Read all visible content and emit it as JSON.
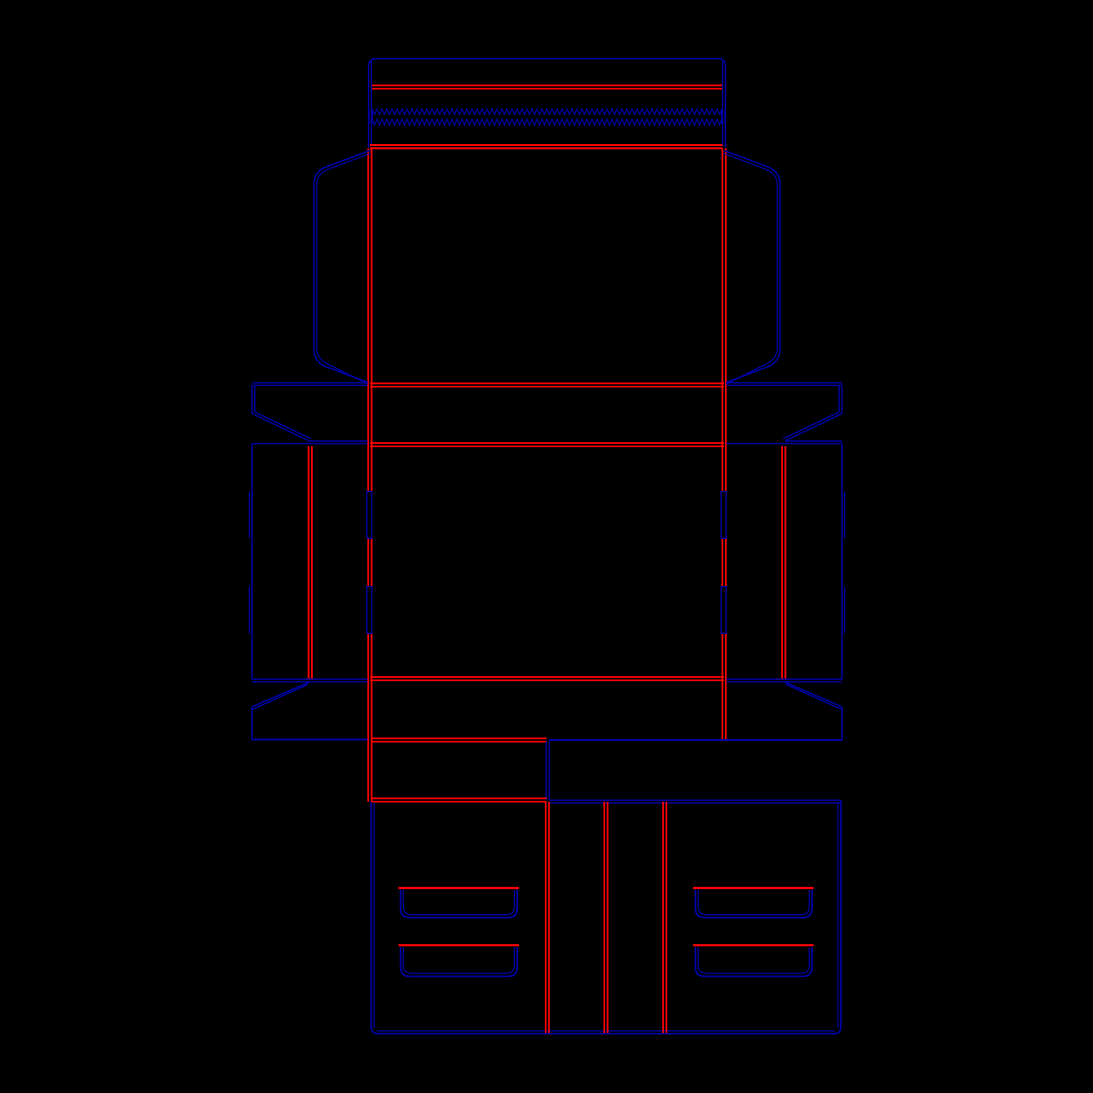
{
  "canvas": {
    "width": 1093,
    "height": 1093,
    "background": "#000000"
  },
  "palette": {
    "cut": "#0000A6",
    "crease": "#FF0000"
  },
  "dieline": {
    "paths": [
      {
        "name": "tuck-flap-outline",
        "color": "cut",
        "width": 1.5,
        "d": "M368.6,147.5 L368.6,66.5 Q368.6,58.6 376.6,58.6 L717.4,58.6 Q725.4,58.6 725.4,66.5 L725.4,147.5"
      },
      {
        "name": "tuck-flap-inner-edge-left",
        "color": "cut",
        "width": 1.2,
        "d": "M371.4,61 V146"
      },
      {
        "name": "tuck-flap-inner-edge-right",
        "color": "cut",
        "width": 1.2,
        "d": "M722.6,61 V146"
      },
      {
        "name": "tuck-flap-crease",
        "color": "crease",
        "width": 1.7,
        "d": "M372,85.4 H722 M372,88.7 H722"
      },
      {
        "name": "tear-strip-end-marks",
        "color": "cut",
        "width": 1.3,
        "d": "M369.1,110.5 V123.5 M372.3,110.5 V123.5 M721.7,110.5 V123.5 M724.9,110.5 V123.5"
      },
      {
        "name": "lid-main-fold",
        "color": "crease",
        "width": 2.0,
        "d": "M370,145 H722.5 M370,148.3 H722.5"
      },
      {
        "name": "lid-fold-left",
        "color": "crease",
        "width": 1.7,
        "d": "M368.2,148.3 V491.5 M368.2,538.3 V586.6 M368.2,633.4 V801.7 M371.6,148.3 V491.5 M371.6,538.3 V586.6 M371.6,633.4 V801.7"
      },
      {
        "name": "lid-fold-right",
        "color": "crease",
        "width": 1.7,
        "d": "M722.4,148.3 V491.5 M722.4,538.3 V586.6 M722.4,633.4 V739.8 M725.8,148.3 V491.5 M725.8,538.3 V586.6 M725.8,633.4 V739.8"
      },
      {
        "name": "dust-flap-left-outer",
        "color": "cut",
        "width": 1.5,
        "d": "M370,150.5 L327,166.5 Q314,171.5 314,183.5 L314,349.5 Q314,359.5 323,365.5 L368,382.5"
      },
      {
        "name": "dust-flap-left-inner",
        "color": "cut",
        "width": 1.2,
        "d": "M370.5,153.3 L328.5,169.2 Q316.8,173.9 316.8,184.5 L316.8,348.2 Q316.8,356.9 324.6,362.3 L367.6,384"
      },
      {
        "name": "dust-flap-right-outer",
        "color": "cut",
        "width": 1.5,
        "d": "M724,150.5 L767,166.5 Q780,171.5 780,183.5 L780,349.5 Q780,359.5 771,365.5 L726,382.5"
      },
      {
        "name": "dust-flap-right-inner",
        "color": "cut",
        "width": 1.2,
        "d": "M723.5,153.3 L765.5,169.2 Q777.2,173.9 777.2,184.5 L777.2,348.2 Q777.2,356.9 769.4,362.3 L726.4,384"
      },
      {
        "name": "lid-bottom-fold",
        "color": "crease",
        "width": 1.7,
        "d": "M370,383.4 H724 M370,386.7 H724"
      },
      {
        "name": "top-band-upper-cut-left",
        "color": "cut",
        "width": 1.4,
        "d": "M252,382.8 H367.6 M252,385.4 H367.6"
      },
      {
        "name": "top-band-upper-cut-right",
        "color": "cut",
        "width": 1.4,
        "d": "M726.4,382.8 H842 M726.4,385.4 H842"
      },
      {
        "name": "top-band-side-left",
        "color": "cut",
        "width": 1.4,
        "d": "M252,385.4 V413.5 M254.8,385.4 V412"
      },
      {
        "name": "top-band-side-right",
        "color": "cut",
        "width": 1.4,
        "d": "M842,385.4 V413.5 M839.2,385.4 V412"
      },
      {
        "name": "top-band-gusset-diagonal-left",
        "color": "cut",
        "width": 1.4,
        "d": "M252,413.5 L309,441 M254.8,412 L311,438.8"
      },
      {
        "name": "top-band-gusset-diagonal-right",
        "color": "cut",
        "width": 1.4,
        "d": "M842,413.5 L785,441 M839.2,412 L783,438.8"
      },
      {
        "name": "top-band-lower-cut-left",
        "color": "cut",
        "width": 1.4,
        "d": "M309,441 H367.6"
      },
      {
        "name": "top-band-lower-cut-right",
        "color": "cut",
        "width": 1.4,
        "d": "M785,441 H842"
      },
      {
        "name": "side-row-top-cut-left",
        "color": "cut",
        "width": 1.4,
        "d": "M252,443.6 H367.6"
      },
      {
        "name": "side-row-top-cut-right",
        "color": "cut",
        "width": 1.4,
        "d": "M726.4,443.6 H842"
      },
      {
        "name": "base-top-fold",
        "color": "crease",
        "width": 1.7,
        "d": "M370,443 H724 M370,446.3 H724"
      },
      {
        "name": "side-row-outer-edge-left",
        "color": "cut",
        "width": 1.5,
        "d": "M252,443.6 V679.2"
      },
      {
        "name": "side-row-outer-edge-right",
        "color": "cut",
        "width": 1.5,
        "d": "M842,443.6 V679.2"
      },
      {
        "name": "side-row-lock-tab-left",
        "color": "cut",
        "width": 1.2,
        "d": "M249.4,491.5 V538.3 M249.4,586.6 V633.4"
      },
      {
        "name": "side-row-lock-tab-right",
        "color": "cut",
        "width": 1.2,
        "d": "M844.6,491.5 V538.3 M844.6,586.6 V633.4"
      },
      {
        "name": "side-wall-crease-left",
        "color": "crease",
        "width": 1.8,
        "d": "M308.6,446.3 V680 M311.9,446.3 V680"
      },
      {
        "name": "side-wall-crease-right",
        "color": "crease",
        "width": 1.8,
        "d": "M782.1,446.3 V680 M785.4,446.3 V680"
      },
      {
        "name": "base-fold-slot-left-1",
        "color": "cut",
        "width": 1.3,
        "d": "M366.8,491.5 h5.0 v46.8 h-5.0 Z"
      },
      {
        "name": "base-fold-slot-left-2",
        "color": "cut",
        "width": 1.3,
        "d": "M366.8,586.6 h5.0 v46.8 h-5.0 Z"
      },
      {
        "name": "base-fold-slot-right-1",
        "color": "cut",
        "width": 1.3,
        "d": "M721.1,491.5 h5.0 v46.8 h-5.0 Z"
      },
      {
        "name": "base-fold-slot-right-2",
        "color": "cut",
        "width": 1.3,
        "d": "M721.1,586.6 h5.0 v46.8 h-5.0 Z"
      },
      {
        "name": "base-bottom-fold",
        "color": "crease",
        "width": 1.7,
        "d": "M370,677 H724 M370,680.3 H724"
      },
      {
        "name": "bottom-band-upper-cut-left",
        "color": "cut",
        "width": 1.4,
        "d": "M252,679.2 H367.6 M252,681.8 H367.6"
      },
      {
        "name": "bottom-band-upper-cut-right",
        "color": "cut",
        "width": 1.4,
        "d": "M726.4,679.2 H842 M726.4,681.8 H842"
      },
      {
        "name": "bottom-band-gusset-diagonal-left",
        "color": "cut",
        "width": 1.4,
        "d": "M310,681.8 L252,706.8 M308,684.4 L252.6,709.4"
      },
      {
        "name": "bottom-band-gusset-diagonal-right",
        "color": "cut",
        "width": 1.4,
        "d": "M784,681.8 L842,706.8 M786,684.4 L841.4,709.4"
      },
      {
        "name": "bottom-band-side-left",
        "color": "cut",
        "width": 1.5,
        "d": "M252,706.8 V739.6"
      },
      {
        "name": "bottom-band-side-right",
        "color": "cut",
        "width": 1.5,
        "d": "M842,706.8 V739.6"
      },
      {
        "name": "bottom-band-lower-cut-left",
        "color": "cut",
        "width": 1.9,
        "d": "M252,739.6 H367.6"
      },
      {
        "name": "bottom-band-lower-cut-right",
        "color": "cut",
        "width": 1.9,
        "d": "M548.5,740 H842"
      },
      {
        "name": "neck-top-fold",
        "color": "crease",
        "width": 1.7,
        "d": "M371,738.4 H546.5 M371,741.7 H546.5"
      },
      {
        "name": "neck-side-cut",
        "color": "cut",
        "width": 1.4,
        "d": "M546.2,741.7 V799.8 M549.2,741.7 V799.8"
      },
      {
        "name": "neck-bottom-fold",
        "color": "crease",
        "width": 1.7,
        "d": "M371,798.4 H546.5 M371,801.7 H546.5"
      },
      {
        "name": "lock-panel-top-cut",
        "color": "cut",
        "width": 1.4,
        "d": "M549.2,800.2 H840.8 M549.2,802.9 H840.8"
      },
      {
        "name": "lock-panel-outline",
        "color": "cut",
        "width": 1.7,
        "d": "M371.3,801.7 L371.3,1026.6 Q371.3,1033.7 378.4,1033.7 L833.7,1033.7 Q840.8,1033.7 840.8,1026.6 L840.8,800.2"
      },
      {
        "name": "lock-panel-inner-edge",
        "color": "cut",
        "width": 1.2,
        "d": "M374.2,803 V1028 M837.9,803 V1028 M377,1030.9 H835"
      },
      {
        "name": "lock-panel-crease-1",
        "color": "crease",
        "width": 1.7,
        "d": "M545.7,801.7 V1033 M549,801.7 V1033"
      },
      {
        "name": "lock-panel-crease-2",
        "color": "crease",
        "width": 1.7,
        "d": "M604.3,801.7 V1033 M607.6,801.7 V1033"
      },
      {
        "name": "lock-panel-crease-3",
        "color": "crease",
        "width": 1.7,
        "d": "M663.1,801.7 V1033 M666.4,801.7 V1033"
      },
      {
        "name": "handle-slot-fold-left-1",
        "color": "crease",
        "width": 2.2,
        "d": "M398.5,888 H519"
      },
      {
        "name": "handle-slot-fold-left-2",
        "color": "crease",
        "width": 2.2,
        "d": "M398.5,945.2 H519"
      },
      {
        "name": "handle-slot-fold-right-1",
        "color": "crease",
        "width": 2.2,
        "d": "M693,888 H813.6"
      },
      {
        "name": "handle-slot-fold-right-2",
        "color": "crease",
        "width": 2.2,
        "d": "M693,945.2 H813.6"
      },
      {
        "name": "handle-slot-cut-left-1",
        "color": "cut",
        "width": 1.7,
        "d": "M400.6,889.8 L400.6,908.4 Q400.6,917.6 409.8,917.6 L508,917.6 Q517.2,917.6 517.2,908.4 L517.2,889.8"
      },
      {
        "name": "handle-slot-cut-left-1-inner",
        "color": "cut",
        "width": 1.2,
        "d": "M403.4,890 L403.4,906.6 Q403.4,914.6 411.4,914.6 L506.4,914.6 Q514.4,914.6 514.4,906.6 L514.4,890"
      },
      {
        "name": "handle-slot-cut-left-2",
        "color": "cut",
        "width": 1.7,
        "d": "M400.6,947 L400.6,967 Q400.6,976.4 410,976.4 L507.8,976.4 Q517.2,976.4 517.2,967 L517.2,947"
      },
      {
        "name": "handle-slot-cut-left-2-inner",
        "color": "cut",
        "width": 1.2,
        "d": "M403.4,947.2 L403.4,965.4 Q403.4,973.2 411.4,973.2 L506.4,973.2 Q514.4,973.2 514.4,965.4 L514.4,947.2"
      },
      {
        "name": "handle-slot-cut-right-1",
        "color": "cut",
        "width": 1.7,
        "d": "M695.4,889.8 L695.4,908.4 Q695.4,917.6 704.6,917.6 L802.8,917.6 Q812,917.6 812,908.4 L812,889.8"
      },
      {
        "name": "handle-slot-cut-right-1-inner",
        "color": "cut",
        "width": 1.2,
        "d": "M698.2,890 L698.2,906.6 Q698.2,914.6 706.2,914.6 L801.2,914.6 Q809.2,914.6 809.2,906.6 L809.2,890"
      },
      {
        "name": "handle-slot-cut-right-2",
        "color": "cut",
        "width": 1.7,
        "d": "M695.4,947 L695.4,967 Q695.4,976.4 704.8,976.4 L802.6,976.4 Q812,976.4 812,967 L812,947"
      },
      {
        "name": "handle-slot-cut-right-2-inner",
        "color": "cut",
        "width": 1.2,
        "d": "M698.2,947.2 L698.2,965.4 Q698.2,973.2 706.2,973.2 L801.2,973.2 Q809.2,973.2 809.2,965.4 L809.2,947.2"
      }
    ],
    "zigzags": [
      {
        "x": 372,
        "to": 722,
        "y": 108.6,
        "amp": 6.2,
        "pitch": 5
      },
      {
        "x": 372,
        "to": 722,
        "y": 118.8,
        "amp": 6.6,
        "pitch": 5
      }
    ]
  }
}
